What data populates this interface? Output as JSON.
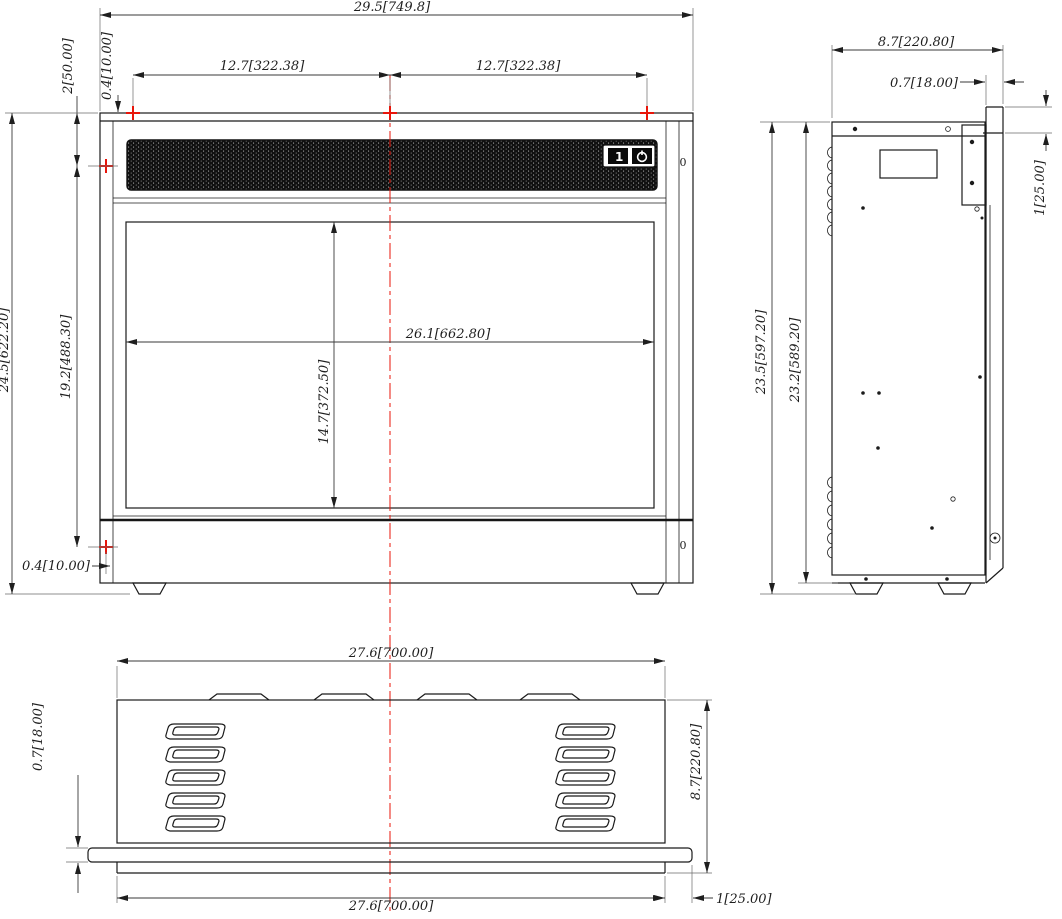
{
  "front": {
    "dim_overall_width": "29.5[749.8]",
    "dim_mount_span_left": "12.7[322.38]",
    "dim_mount_span_right": "12.7[322.38]",
    "dim_mount_top_offset": "0.4[10.00]",
    "dim_top_to_side_mount": "2[50.00]",
    "dim_overall_height": "24.5[622.20]",
    "dim_side_mount_span": "19.2[488.30]",
    "dim_opening_width": "26.1[662.80]",
    "dim_opening_height": "14.7[372.50]",
    "dim_side_mount_offset": "0.4[10.00]",
    "switch_on": "1",
    "hole_label_top": "0",
    "hole_label_bottom": "0"
  },
  "side": {
    "dim_depth": "8.7[220.80]",
    "dim_flange_thickness": "0.7[18.00]",
    "dim_flange_lip": "1[25.00]",
    "dim_overall_height": "23.5[597.20]",
    "dim_body_height": "23.2[589.20]"
  },
  "bottom": {
    "dim_width_top": "27.6[700.00]",
    "dim_width_bottom": "27.6[700.00]",
    "dim_strip_thickness": "0.7[18.00]",
    "dim_depth": "8.7[220.80]",
    "dim_flange_overhang": "1[25.00]"
  },
  "icons": {
    "power": "power-icon",
    "mount_marker": "mount-cross-icon"
  },
  "colors": {
    "accent_red": "#e8150a",
    "line": "#1b1b1b",
    "grille": "#101010"
  }
}
